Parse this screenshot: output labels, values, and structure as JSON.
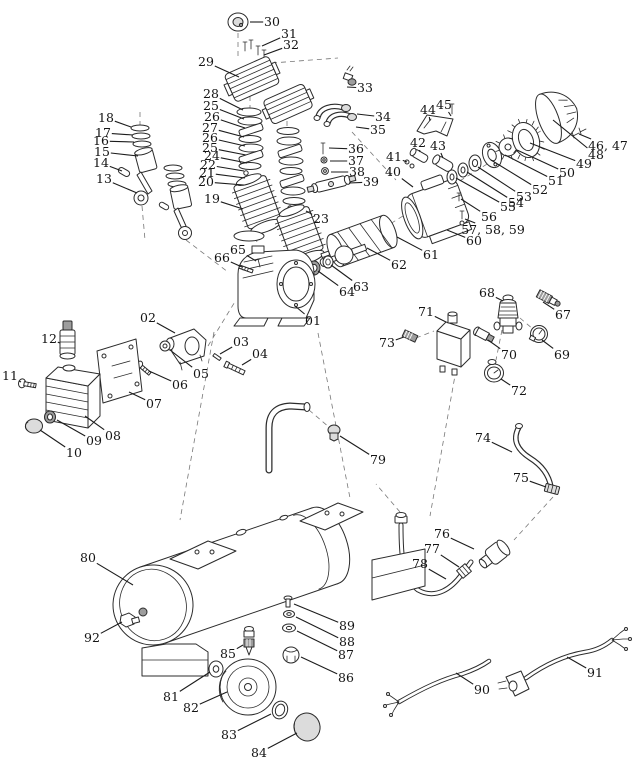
{
  "meta": {
    "title": "Air compressor exploded-view parts diagram",
    "type": "exploded-parts-diagram",
    "background": "#ffffff",
    "ink": "#2b2b2b",
    "label_color": "#141414"
  },
  "diagram": {
    "canvas": {
      "width": 640,
      "height": 768
    },
    "labels": [
      {
        "text": "30",
        "tx": 272,
        "ty": 22,
        "px": 250,
        "py": 22
      },
      {
        "text": "31",
        "tx": 289,
        "ty": 34,
        "px": 262,
        "py": 46
      },
      {
        "text": "32",
        "tx": 291,
        "ty": 45,
        "px": 264,
        "py": 55
      },
      {
        "text": "29",
        "tx": 206,
        "ty": 62,
        "px": 239,
        "py": 77
      },
      {
        "text": "33",
        "tx": 365,
        "ty": 88,
        "px": 347,
        "py": 87
      },
      {
        "text": "28",
        "tx": 211,
        "ty": 94,
        "px": 243,
        "py": 110
      },
      {
        "text": "25",
        "tx": 211,
        "ty": 106,
        "px": 244,
        "py": 119
      },
      {
        "text": "26",
        "tx": 212,
        "ty": 117,
        "px": 245,
        "py": 128
      },
      {
        "text": "27",
        "tx": 210,
        "ty": 128,
        "px": 244,
        "py": 137
      },
      {
        "text": "26",
        "tx": 210,
        "ty": 138,
        "px": 245,
        "py": 146
      },
      {
        "text": "25",
        "tx": 210,
        "ty": 148,
        "px": 246,
        "py": 155
      },
      {
        "text": "24",
        "tx": 212,
        "ty": 156,
        "px": 247,
        "py": 163
      },
      {
        "text": "22",
        "tx": 208,
        "ty": 165,
        "px": 244,
        "py": 171
      },
      {
        "text": "21",
        "tx": 207,
        "ty": 173,
        "px": 245,
        "py": 178
      },
      {
        "text": "20",
        "tx": 206,
        "ty": 182,
        "px": 244,
        "py": 185
      },
      {
        "text": "19",
        "tx": 212,
        "ty": 199,
        "px": 243,
        "py": 209
      },
      {
        "text": "18",
        "tx": 106,
        "ty": 118,
        "px": 131,
        "py": 127
      },
      {
        "text": "17",
        "tx": 103,
        "ty": 133,
        "px": 133,
        "py": 135
      },
      {
        "text": "16",
        "tx": 101,
        "ty": 141,
        "px": 134,
        "py": 142
      },
      {
        "text": "15",
        "tx": 102,
        "ty": 152,
        "px": 138,
        "py": 156
      },
      {
        "text": "14",
        "tx": 101,
        "ty": 163,
        "px": 122,
        "py": 171
      },
      {
        "text": "13",
        "tx": 104,
        "ty": 179,
        "px": 137,
        "py": 193
      },
      {
        "text": "34",
        "tx": 383,
        "ty": 117,
        "px": 357,
        "py": 114
      },
      {
        "text": "35",
        "tx": 378,
        "ty": 130,
        "px": 356,
        "py": 127
      },
      {
        "text": "36",
        "tx": 356,
        "ty": 149,
        "px": 329,
        "py": 148
      },
      {
        "text": "37",
        "tx": 356,
        "ty": 161,
        "px": 330,
        "py": 161
      },
      {
        "text": "38",
        "tx": 357,
        "ty": 172,
        "px": 331,
        "py": 172
      },
      {
        "text": "39",
        "tx": 371,
        "ty": 182,
        "px": 349,
        "py": 183
      },
      {
        "text": "44",
        "tx": 428,
        "ty": 110,
        "px": 430,
        "py": 121
      },
      {
        "text": "45",
        "tx": 444,
        "ty": 105,
        "px": 451,
        "py": 116
      },
      {
        "text": "42",
        "tx": 418,
        "ty": 143,
        "px": 420,
        "py": 152
      },
      {
        "text": "43",
        "tx": 438,
        "ty": 146,
        "px": 443,
        "py": 158
      },
      {
        "text": "41",
        "tx": 394,
        "ty": 157,
        "px": 407,
        "py": 162
      },
      {
        "text": "40",
        "tx": 393,
        "ty": 172,
        "px": 413,
        "py": 187
      },
      {
        "text": "46, 47",
        "tx": 608,
        "ty": 146,
        "px": 579,
        "py": 134
      },
      {
        "text": "48",
        "tx": 596,
        "ty": 155,
        "px": 553,
        "py": 120
      },
      {
        "text": "49",
        "tx": 584,
        "ty": 164,
        "px": 530,
        "py": 143
      },
      {
        "text": "50",
        "tx": 567,
        "ty": 173,
        "px": 517,
        "py": 150
      },
      {
        "text": "51",
        "tx": 556,
        "ty": 181,
        "px": 505,
        "py": 155
      },
      {
        "text": "52",
        "tx": 540,
        "ty": 190,
        "px": 491,
        "py": 160
      },
      {
        "text": "53",
        "tx": 524,
        "ty": 197,
        "px": 478,
        "py": 167
      },
      {
        "text": "54",
        "tx": 516,
        "ty": 203,
        "px": 467,
        "py": 172
      },
      {
        "text": "55",
        "tx": 508,
        "ty": 207,
        "px": 456,
        "py": 178
      },
      {
        "text": "56",
        "tx": 489,
        "ty": 217,
        "px": 461,
        "py": 199
      },
      {
        "text": "57, 58, 59",
        "tx": 493,
        "ty": 230,
        "px": 465,
        "py": 219
      },
      {
        "text": "60",
        "tx": 474,
        "ty": 241,
        "px": 447,
        "py": 230
      },
      {
        "text": "61",
        "tx": 431,
        "ty": 255,
        "px": 397,
        "py": 237
      },
      {
        "text": "62",
        "tx": 399,
        "ty": 265,
        "px": 367,
        "py": 248
      },
      {
        "text": "63",
        "tx": 361,
        "ty": 287,
        "px": 331,
        "py": 265
      },
      {
        "text": "64",
        "tx": 347,
        "ty": 292,
        "px": 318,
        "py": 271
      },
      {
        "text": "65",
        "tx": 238,
        "ty": 250,
        "px": 256,
        "py": 261
      },
      {
        "text": "66",
        "tx": 222,
        "ty": 258,
        "px": 242,
        "py": 267
      },
      {
        "text": "23",
        "tx": 321,
        "ty": 219,
        "px": 306,
        "py": 211
      },
      {
        "text": "01",
        "tx": 313,
        "ty": 321,
        "px": 295,
        "py": 306
      },
      {
        "text": "02",
        "tx": 148,
        "ty": 318,
        "px": 175,
        "py": 333
      },
      {
        "text": "03",
        "tx": 241,
        "ty": 342,
        "px": 220,
        "py": 354
      },
      {
        "text": "04",
        "tx": 260,
        "ty": 354,
        "px": 242,
        "py": 365
      },
      {
        "text": "05",
        "tx": 201,
        "ty": 374,
        "px": 170,
        "py": 350
      },
      {
        "text": "06",
        "tx": 180,
        "ty": 385,
        "px": 149,
        "py": 371
      },
      {
        "text": "07",
        "tx": 154,
        "ty": 404,
        "px": 129,
        "py": 392
      },
      {
        "text": "12",
        "tx": 49,
        "ty": 339,
        "px": 60,
        "py": 343
      },
      {
        "text": "11",
        "tx": 10,
        "ty": 376,
        "px": 21,
        "py": 382
      },
      {
        "text": "08",
        "tx": 113,
        "ty": 436,
        "px": 85,
        "py": 416
      },
      {
        "text": "09",
        "tx": 94,
        "ty": 441,
        "px": 57,
        "py": 420
      },
      {
        "text": "10",
        "tx": 74,
        "ty": 453,
        "px": 40,
        "py": 430
      },
      {
        "text": "71",
        "tx": 426,
        "ty": 312,
        "px": 446,
        "py": 322
      },
      {
        "text": "68",
        "tx": 487,
        "ty": 293,
        "px": 503,
        "py": 301
      },
      {
        "text": "67",
        "tx": 563,
        "ty": 315,
        "px": 543,
        "py": 302
      },
      {
        "text": "70",
        "tx": 509,
        "ty": 355,
        "px": 488,
        "py": 340
      },
      {
        "text": "69",
        "tx": 562,
        "ty": 355,
        "px": 542,
        "py": 340
      },
      {
        "text": "72",
        "tx": 519,
        "ty": 391,
        "px": 501,
        "py": 379
      },
      {
        "text": "73",
        "tx": 387,
        "ty": 343,
        "px": 404,
        "py": 337
      },
      {
        "text": "79",
        "tx": 378,
        "ty": 460,
        "px": 340,
        "py": 436
      },
      {
        "text": "74",
        "tx": 483,
        "ty": 438,
        "px": 512,
        "py": 452
      },
      {
        "text": "75",
        "tx": 521,
        "ty": 478,
        "px": 546,
        "py": 487
      },
      {
        "text": "76",
        "tx": 442,
        "ty": 534,
        "px": 474,
        "py": 549
      },
      {
        "text": "77",
        "tx": 432,
        "ty": 549,
        "px": 459,
        "py": 567
      },
      {
        "text": "78",
        "tx": 420,
        "ty": 564,
        "px": 446,
        "py": 579
      },
      {
        "text": "80",
        "tx": 88,
        "ty": 558,
        "px": 133,
        "py": 585
      },
      {
        "text": "92",
        "tx": 92,
        "ty": 638,
        "px": 122,
        "py": 622
      },
      {
        "text": "85",
        "tx": 228,
        "ty": 654,
        "px": 243,
        "py": 645
      },
      {
        "text": "81",
        "tx": 171,
        "ty": 697,
        "px": 210,
        "py": 672
      },
      {
        "text": "82",
        "tx": 191,
        "ty": 708,
        "px": 227,
        "py": 692
      },
      {
        "text": "83",
        "tx": 229,
        "ty": 735,
        "px": 271,
        "py": 714
      },
      {
        "text": "84",
        "tx": 259,
        "ty": 753,
        "px": 297,
        "py": 733
      },
      {
        "text": "86",
        "tx": 346,
        "ty": 678,
        "px": 301,
        "py": 657
      },
      {
        "text": "87",
        "tx": 346,
        "ty": 655,
        "px": 297,
        "py": 631
      },
      {
        "text": "88",
        "tx": 347,
        "ty": 642,
        "px": 296,
        "py": 617
      },
      {
        "text": "89",
        "tx": 347,
        "ty": 626,
        "px": 294,
        "py": 604
      },
      {
        "text": "90",
        "tx": 482,
        "ty": 690,
        "px": 456,
        "py": 673
      },
      {
        "text": "91",
        "tx": 595,
        "ty": 673,
        "px": 567,
        "py": 657
      }
    ]
  }
}
